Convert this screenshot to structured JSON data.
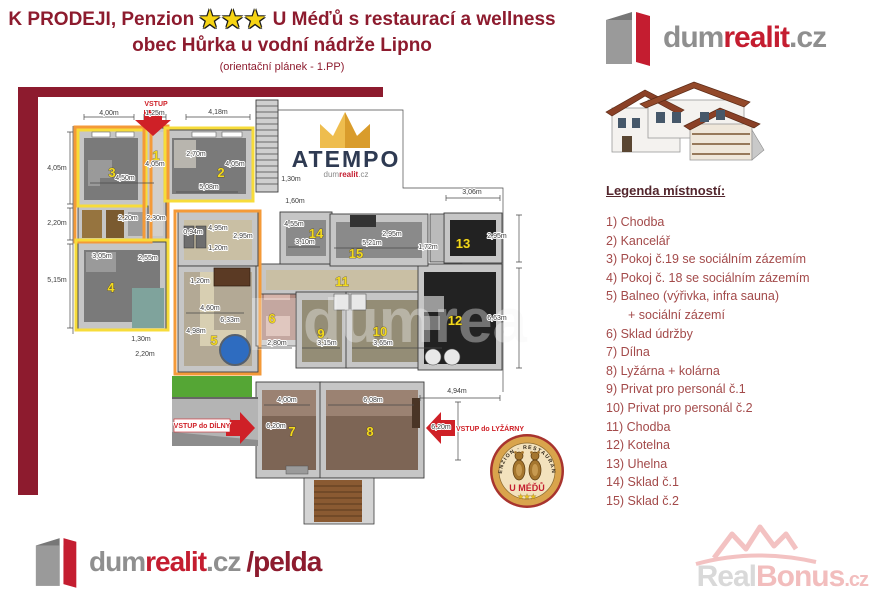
{
  "header": {
    "title_prefix": "K PRODEJI, Penzion",
    "stars": "★★★",
    "title_suffix": "U Méďů s restaurací a wellness",
    "subtitle": "obec Hůrka u vodní nádrže Lipno",
    "note": "(orientační plánek - 1.PP)"
  },
  "brand_top": {
    "dum": "dum",
    "realit": "realit",
    "cz": ".cz"
  },
  "brand_bottom": {
    "dum": "dum",
    "realit": "realit",
    "cz": ".cz",
    "agent": "/pelda"
  },
  "watermark_realbonus": {
    "real": "Real",
    "bonus": "Bonus",
    "cz": ".cz"
  },
  "watermark_atempo": {
    "name": "ATEMPO",
    "dum": "dum",
    "realit": "realit",
    "cz": ".cz"
  },
  "badge": {
    "arc": "PENZION · RESTAURANT",
    "name": "U MÉĎŮ",
    "stars": "★★★"
  },
  "legend": {
    "heading": "Legenda místností:",
    "items": [
      "1) Chodba",
      "2) Kancelář",
      "3) Pokoj č.19 se sociálním zázemím",
      "4) Pokoj č. 18 se sociálním zázemím",
      "5) Balneo (výřivka, infra sauna)",
      "+ sociální zázemí",
      "6) Sklad údržby",
      "7) Dílna",
      "8) Lyžárna + kolárna",
      "9) Privat pro personál č.1",
      "10) Privat pro personál č.2",
      "11) Chodba",
      "12) Kotelna",
      "13) Uhelna",
      "14) Sklad č.1",
      "15) Sklad č.2"
    ]
  },
  "plan": {
    "room_numbers": [
      {
        "n": "1",
        "x": 156,
        "y": 160
      },
      {
        "n": "2",
        "x": 221,
        "y": 177
      },
      {
        "n": "3",
        "x": 112,
        "y": 177
      },
      {
        "n": "4",
        "x": 111,
        "y": 292
      },
      {
        "n": "5",
        "x": 214,
        "y": 345,
        "s": 15
      },
      {
        "n": "6",
        "x": 272,
        "y": 323
      },
      {
        "n": "7",
        "x": 292,
        "y": 436,
        "s": 15
      },
      {
        "n": "8",
        "x": 370,
        "y": 436,
        "s": 15
      },
      {
        "n": "9",
        "x": 321,
        "y": 338
      },
      {
        "n": "10",
        "x": 380,
        "y": 336
      },
      {
        "n": "11",
        "x": 342,
        "y": 286
      },
      {
        "n": "12",
        "x": 455,
        "y": 325
      },
      {
        "n": "13",
        "x": 463,
        "y": 248
      },
      {
        "n": "14",
        "x": 316,
        "y": 238
      },
      {
        "n": "15",
        "x": 356,
        "y": 258
      }
    ],
    "dimensions": [
      {
        "t": "4,00m",
        "x": 109,
        "y": 115
      },
      {
        "t": "1,25m",
        "x": 155,
        "y": 115
      },
      {
        "t": "4,18m",
        "x": 218,
        "y": 114
      },
      {
        "t": "4,05m",
        "x": 57,
        "y": 170
      },
      {
        "t": "2,20m",
        "x": 57,
        "y": 225
      },
      {
        "t": "5,15m",
        "x": 57,
        "y": 282
      },
      {
        "t": "4,50m",
        "x": 125,
        "y": 180
      },
      {
        "t": "4,05m",
        "x": 155,
        "y": 166
      },
      {
        "t": "2,70m",
        "x": 196,
        "y": 156
      },
      {
        "t": "4,05m",
        "x": 235,
        "y": 166
      },
      {
        "t": "5,08m",
        "x": 209,
        "y": 189
      },
      {
        "t": "2,20m",
        "x": 128,
        "y": 220
      },
      {
        "t": "2,30m",
        "x": 156,
        "y": 220
      },
      {
        "t": "3,05m",
        "x": 102,
        "y": 258
      },
      {
        "t": "2,55m",
        "x": 148,
        "y": 260
      },
      {
        "t": "1,30m",
        "x": 141,
        "y": 341
      },
      {
        "t": "2,20m",
        "x": 145,
        "y": 356
      },
      {
        "t": "0,94m",
        "x": 193,
        "y": 234
      },
      {
        "t": "4,95m",
        "x": 218,
        "y": 230
      },
      {
        "t": "2,95m",
        "x": 243,
        "y": 238
      },
      {
        "t": "1,20m",
        "x": 218,
        "y": 250
      },
      {
        "t": "1,20m",
        "x": 200,
        "y": 283
      },
      {
        "t": "4,60m",
        "x": 210,
        "y": 310
      },
      {
        "t": "6,33m",
        "x": 230,
        "y": 322
      },
      {
        "t": "4,98m",
        "x": 196,
        "y": 333
      },
      {
        "t": "2,80m",
        "x": 277,
        "y": 345
      },
      {
        "t": "1,30m",
        "x": 291,
        "y": 181
      },
      {
        "t": "1,60m",
        "x": 295,
        "y": 203
      },
      {
        "t": "4,55m",
        "x": 294,
        "y": 226
      },
      {
        "t": "3,10m",
        "x": 305,
        "y": 244
      },
      {
        "t": "5,21m",
        "x": 372,
        "y": 245
      },
      {
        "t": "2,95m",
        "x": 392,
        "y": 236
      },
      {
        "t": "3,06m",
        "x": 472,
        "y": 194
      },
      {
        "t": "2,95m",
        "x": 497,
        "y": 238
      },
      {
        "t": "1,72m",
        "x": 428,
        "y": 249
      },
      {
        "t": "6,63m",
        "x": 497,
        "y": 320
      },
      {
        "t": "4,94m",
        "x": 457,
        "y": 393
      },
      {
        "t": "6,20m",
        "x": 441,
        "y": 429
      },
      {
        "t": "4,00m",
        "x": 287,
        "y": 402
      },
      {
        "t": "6,08m",
        "x": 373,
        "y": 402
      },
      {
        "t": "6,20m",
        "x": 276,
        "y": 428
      },
      {
        "t": "3,15m",
        "x": 327,
        "y": 345
      },
      {
        "t": "3,65m",
        "x": 383,
        "y": 345
      }
    ],
    "entrances": [
      {
        "label": "VSTUP",
        "x": 156,
        "y": 106
      },
      {
        "label": "VSTUP do DÍLNY",
        "x": 202,
        "y": 428
      },
      {
        "label": "VSTUP do LYŽÁRNY",
        "x": 490,
        "y": 431
      }
    ]
  }
}
